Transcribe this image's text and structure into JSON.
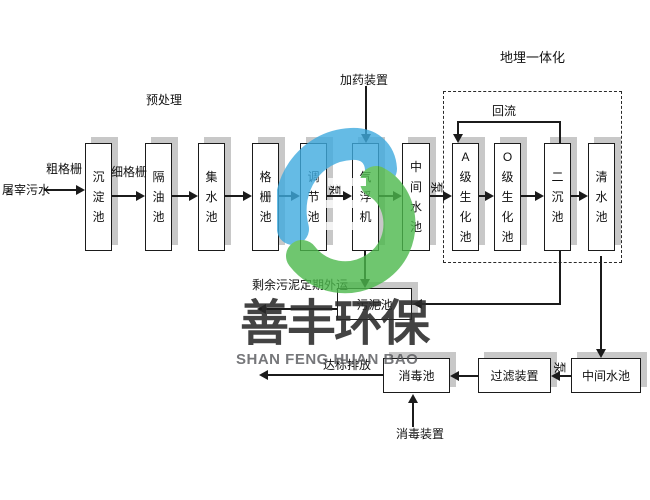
{
  "labels": {
    "inflow": "屠宰污水",
    "coarse_grid": "粗格栅",
    "fine_grid": "细格栅",
    "pretreatment": "预处理",
    "dosing_device": "加药装置",
    "buried_integration": "地埋一体化",
    "reflux": "回流",
    "pump": "泵",
    "sludge_out": "剩余污泥定期外运",
    "discharge": "达标排放",
    "disinfection_device": "消毒装置"
  },
  "tanks": {
    "sedimentation": "沉淀池",
    "oil_separation": "隔油池",
    "collecting": "集水池",
    "grid": "格栅池",
    "regulating": "调节池",
    "air_flotation": "气浮机",
    "intermediate": "中间水池",
    "a_biochemical": "A级生化池",
    "o_biochemical": "O级生化池",
    "secondary_sedimentation": "二沉池",
    "clear_water": "清水池",
    "sludge": "污泥池",
    "disinfection": "消毒池",
    "filter_device": "过滤装置",
    "intermediate2": "中间水池"
  },
  "watermark": {
    "cn": "善丰环保",
    "en": "SHAN FENG HUAN BAO"
  },
  "colors": {
    "logo_blue": "#3FABDF",
    "logo_green": "#4CB84C",
    "shadow": "#C8C8C8",
    "line": "#1B1B1B"
  }
}
